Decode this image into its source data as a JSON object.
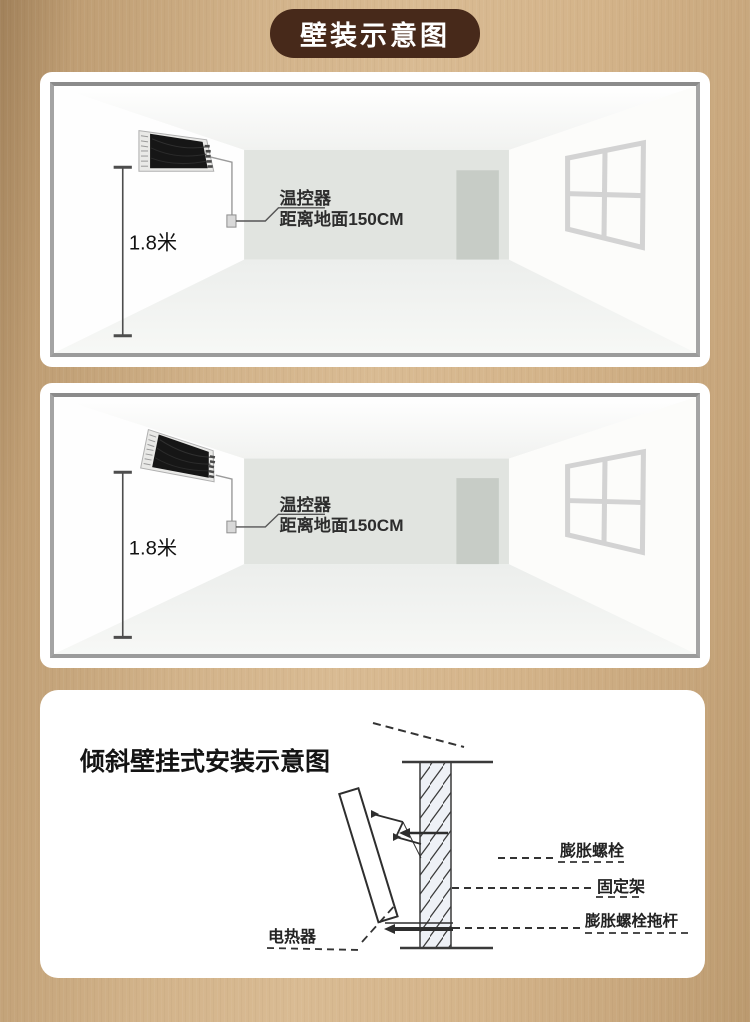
{
  "header": {
    "title": "壁装示意图"
  },
  "colors": {
    "title_pill_bg": "#47291a",
    "background_tan": "#d2b38a",
    "card_bg": "#ffffff",
    "frame_border": "#a4a4a4",
    "back_wall": "#e1e4e0",
    "door": "#c7ccc6",
    "heater_screen": "#161616",
    "diagram_line": "#333333"
  },
  "panel_top": {
    "height_label": "1.8米",
    "thermostat_line1": "温控器",
    "thermostat_line2": "距离地面150CM"
  },
  "panel_middle": {
    "height_label": "1.8米",
    "thermostat_line1": "温控器",
    "thermostat_line2": "距离地面150CM"
  },
  "panel_bottom": {
    "title": "倾斜壁挂式安装示意图",
    "label_expansion_bolt": "膨胀螺栓",
    "label_fixing_bracket": "固定架",
    "label_bolt_rod": "膨胀螺栓拖杆",
    "label_heater": "电热器"
  }
}
